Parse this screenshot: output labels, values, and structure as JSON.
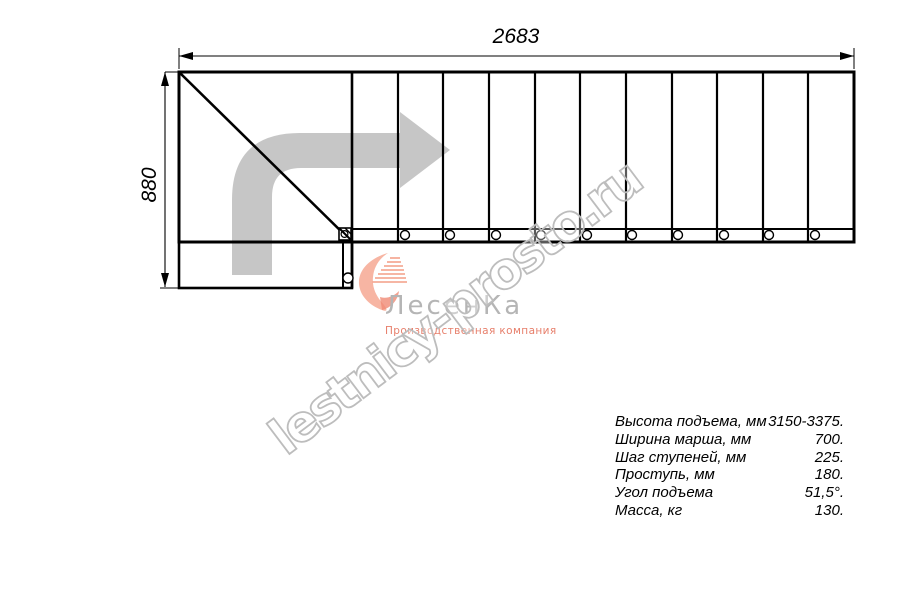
{
  "drawing": {
    "width_label": "2683",
    "height_label": "880",
    "steps_visible": 11,
    "line_color": "#000000",
    "direction_arrow_color": "#c6c6c6"
  },
  "watermark": {
    "text": "lestnicy-prosto.ru",
    "color": "#bdbdbd"
  },
  "logo": {
    "name": "ЛесенКа",
    "tagline": "Производственная компания",
    "icon": "stairs-heart-icon",
    "icon_color": "#f6a893",
    "name_color": "#b5b5b5",
    "tagline_color": "#e77f6b"
  },
  "specs": {
    "rows": [
      {
        "label": "Высота подъема, мм",
        "value": "3150-3375."
      },
      {
        "label": "Ширина марша, мм",
        "value": "700."
      },
      {
        "label": "Шаг ступеней, мм",
        "value": "225."
      },
      {
        "label": "Проступь, мм",
        "value": "180."
      },
      {
        "label": "Угол подъема",
        "value": "51,5°."
      },
      {
        "label": "Масса, кг",
        "value": "130."
      }
    ]
  }
}
